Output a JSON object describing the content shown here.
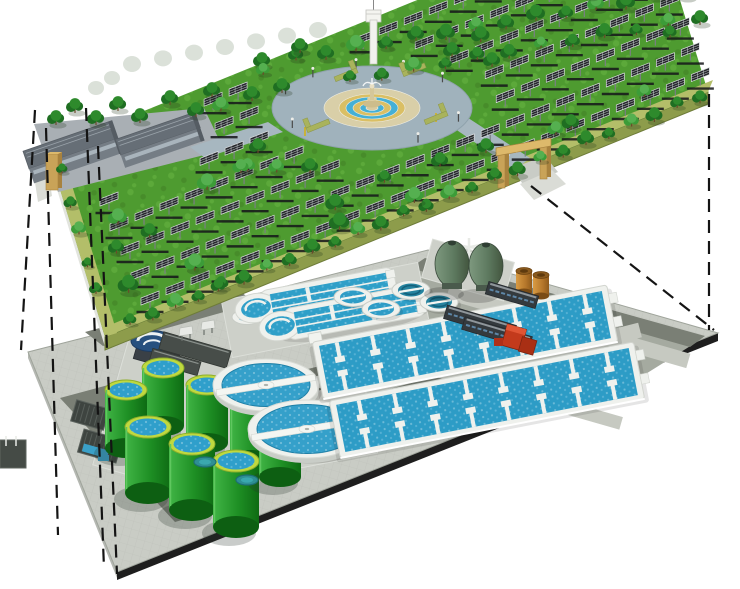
{
  "canvas": {
    "width": 740,
    "height": 589,
    "background": "#ffffff"
  },
  "palette": {
    "grass": "#4E9B30",
    "grass_light": "#5CA93A",
    "grass_dark": "#478C2A",
    "edge_walk": "#B3BE69",
    "front_face": "#8D9C4B",
    "left_face": "#E2E4DE",
    "road_upper": "#A7B7C0",
    "plaza_ring": "#A0B2BC",
    "plaza_beige": "#D9CFA8",
    "plaza_tan": "#DABF64",
    "plaza_blue": "#45B0D6",
    "fountain_stone": "#CDBD8C",
    "tan_gate": "#C9A358",
    "tan_gate_dark": "#A8823E",
    "tan_gate_light": "#DDB96B",
    "panel_cell": "#26282C",
    "panel_grid": "#C9CDD2",
    "panel_shadow": "#15161A",
    "tree_dark": "#1F6E22",
    "tree_mid": "#2E8A2C",
    "tree_light": "#3C9C38",
    "tree_faded": "#DBE1D9",
    "building_roof": "#666E76",
    "building_wall": "#757D85",
    "building_band": "#A9B4BC",
    "lower_base": "#C9CCC5",
    "lower_pad_med": "#A5AAA0",
    "road_dark": "#7A7F75",
    "road_light": "#C6C9C1",
    "edge_dark": "#1E1E1E",
    "side_light": "#B5B8B2",
    "tank_green": "#229426",
    "tank_green_dark": "#0F6B14",
    "tank_rim": "#BFD93F",
    "water_blue": "#2F9FC8",
    "water_deep": "#25839F",
    "white_struct": "#EFF1ED",
    "white_stroke": "#D2D5CF",
    "navy": "#27507F",
    "egg_green": "#5E7A60",
    "egg_dark": "#46604B",
    "barrel": "#C08030",
    "red_unit": "#C33A1C",
    "dash_line": "#141414"
  },
  "upper_level": {
    "polygon": [
      [
        48,
        150
      ],
      [
        651,
        -95
      ],
      [
        708,
        92
      ],
      [
        105,
        337
      ]
    ],
    "faces": {
      "front": [
        [
          105,
          337
        ],
        [
          708,
          92
        ],
        [
          708,
          104
        ],
        [
          105,
          350
        ]
      ],
      "left": [
        [
          48,
          150
        ],
        [
          105,
          337
        ],
        [
          105,
          347
        ],
        [
          48,
          160
        ]
      ]
    },
    "edge_walks": [
      [
        [
          105,
          337
        ],
        [
          708,
          92
        ],
        [
          713,
          80
        ],
        [
          110,
          325
        ]
      ],
      [
        [
          48,
          150
        ],
        [
          105,
          337
        ],
        [
          117,
          333
        ],
        [
          60,
          146
        ]
      ]
    ],
    "backdrop_slab": [
      [
        352,
        92
      ],
      [
        392,
        30
      ],
      [
        470,
        52
      ],
      [
        452,
        96
      ]
    ],
    "building_pad": [
      [
        34,
        124
      ],
      [
        204,
        108
      ],
      [
        224,
        150
      ],
      [
        58,
        192
      ]
    ],
    "roads": [
      [
        [
          268,
          122
        ],
        [
          283,
          132
        ],
        [
          205,
          158
        ],
        [
          190,
          147
        ]
      ],
      [
        [
          448,
          124
        ],
        [
          462,
          114
        ],
        [
          530,
          158
        ],
        [
          515,
          170
        ]
      ]
    ],
    "gate_aprons": [
      [
        [
          512,
          168
        ],
        [
          545,
          156
        ],
        [
          558,
          172
        ],
        [
          524,
          186
        ]
      ],
      [
        [
          520,
          184
        ],
        [
          552,
          170
        ],
        [
          566,
          184
        ],
        [
          534,
          200
        ]
      ],
      [
        [
          34,
          176
        ],
        [
          48,
          170
        ],
        [
          52,
          196
        ],
        [
          38,
          202
        ]
      ]
    ],
    "panel_field": {
      "row_starts": [
        [
          150,
          305
        ],
        [
          140,
          280
        ],
        [
          130,
          255
        ],
        [
          119,
          231
        ],
        [
          109,
          206
        ],
        [
          99,
          181
        ],
        [
          88,
          157
        ],
        [
          78,
          132
        ],
        [
          68,
          107
        ]
      ],
      "count": 24,
      "spacing": 27,
      "angle_deg": -22.1,
      "exclusions": {
        "plaza": {
          "cx": 372,
          "cy": 108,
          "rx": 118,
          "ry": 58
        },
        "buildings_rect": {
          "x1": 30,
          "y1": 105,
          "x2": 205,
          "y2": 198
        },
        "front_margin": 10,
        "left_margin": 14
      }
    },
    "plaza": {
      "cx": 372,
      "cy": 108,
      "rings": [
        {
          "rx": 100,
          "ry": 42,
          "fill": "ring_road"
        },
        {
          "rx": 48,
          "ry": 20,
          "fill": "beige"
        },
        {
          "rx": 33,
          "ry": 14,
          "fill": "tan"
        },
        {
          "rx": 26,
          "ry": 11,
          "fill": "blue"
        },
        {
          "rx": 19,
          "ry": 8,
          "fill": "tan"
        },
        {
          "rx": 12,
          "ry": 5,
          "fill": "blue"
        },
        {
          "rx": 6,
          "ry": 2.5,
          "fill": "island"
        }
      ],
      "pole_angles": [
        200,
        230,
        260,
        290,
        320,
        20,
        60,
        150
      ],
      "yellow_poles": [
        [
          436,
          122
        ],
        [
          305,
          136
        ]
      ],
      "planters": [
        {
          "x": 306,
          "y": 128,
          "flip": 0
        },
        {
          "x": 424,
          "y": 120,
          "flip": 1
        },
        {
          "x": 334,
          "y": 77,
          "flip": 1
        },
        {
          "x": 402,
          "y": 72,
          "flip": 0
        }
      ]
    },
    "buildings": [
      {
        "cx": 73,
        "cy": 152,
        "w": 94,
        "h": 34,
        "ang": -19
      },
      {
        "cx": 160,
        "cy": 140,
        "w": 84,
        "h": 30,
        "ang": -19
      }
    ],
    "gates": {
      "left_slab": {
        "x": 46,
        "y": 154
      },
      "right_posts": [
        [
          498,
          154
        ],
        [
          540,
          145
        ]
      ],
      "right_lintel": [
        [
          496,
          148
        ],
        [
          551,
          138
        ],
        [
          551,
          146
        ],
        [
          496,
          156
        ]
      ]
    },
    "tower": {
      "shaft": [
        370,
        20,
        7,
        44
      ],
      "cap": [
        366,
        10,
        15,
        12
      ],
      "antenna_x": 373.5
    },
    "tree_rows": [
      {
        "from": [
          130,
          323
        ],
        "to": [
          700,
          97
        ],
        "n": 26,
        "r": 8
      },
      {
        "from": [
          296,
          58
        ],
        "to": [
          686,
          -8
        ],
        "n": 14,
        "r": 9
      },
      {
        "from": [
          350,
          80
        ],
        "to": [
          700,
          18
        ],
        "n": 12,
        "r": 8
      },
      {
        "from": [
          62,
          172
        ],
        "to": [
          96,
          292
        ],
        "n": 5,
        "r": 7
      }
    ],
    "tree_singles": [
      [
        56,
        120
      ],
      [
        75,
        108
      ],
      [
        96,
        120
      ],
      [
        118,
        106
      ],
      [
        140,
        118
      ],
      [
        170,
        100
      ],
      [
        196,
        112
      ],
      [
        212,
        92
      ],
      [
        252,
        96
      ],
      [
        282,
        88
      ],
      [
        262,
        62
      ],
      [
        300,
        48
      ],
      [
        452,
        52
      ],
      [
        492,
        62
      ],
      [
        258,
        148
      ],
      [
        310,
        168
      ],
      [
        440,
        162
      ],
      [
        486,
        148
      ]
    ],
    "faded_trees": {
      "row_from": [
        132,
        64
      ],
      "row_to": [
        318,
        30
      ],
      "n": 7,
      "extra": [
        [
          96,
          88
        ],
        [
          112,
          78
        ]
      ]
    },
    "scatter": {
      "seed": 7,
      "count": 24
    }
  },
  "lower_level": {
    "polygon": [
      [
        428,
        250
      ],
      [
        718,
        333
      ],
      [
        117,
        572
      ],
      [
        28,
        352
      ]
    ],
    "faces": {
      "se": [
        [
          117,
          572
        ],
        [
          718,
          333
        ],
        [
          718,
          341
        ],
        [
          117,
          580
        ]
      ],
      "sw": [
        [
          28,
          352
        ],
        [
          117,
          572
        ],
        [
          117,
          578
        ],
        [
          28,
          358
        ]
      ]
    },
    "pad_right": [
      [
        420,
        265
      ],
      [
        700,
        340
      ],
      [
        580,
        415
      ],
      [
        330,
        348
      ]
    ],
    "roads_dark": [
      [
        [
          85,
          332
        ],
        [
          238,
          290
        ],
        [
          256,
          303
        ],
        [
          103,
          346
        ]
      ],
      [
        [
          128,
          462
        ],
        [
          465,
          368
        ],
        [
          530,
          402
        ],
        [
          192,
          500
        ]
      ],
      [
        [
          60,
          398
        ],
        [
          112,
          384
        ],
        [
          230,
          506
        ],
        [
          175,
          522
        ]
      ],
      [
        [
          425,
          258
        ],
        [
          705,
          336
        ],
        [
          690,
          347
        ],
        [
          410,
          268
        ]
      ]
    ],
    "roads_light": [
      {
        "from": [
          448,
          292
        ],
        "len": 250,
        "axis": "a",
        "w": 15
      },
      {
        "from": [
          640,
          330
        ],
        "len": 200,
        "axis": "b",
        "w": 15
      },
      {
        "from": [
          400,
          360
        ],
        "len": 230,
        "axis": "a",
        "w": 13
      }
    ],
    "stripes": [
      [
        196,
        402
      ],
      [
        196,
        424
      ],
      [
        196,
        446
      ]
    ],
    "pads_light": [
      {
        "cx": 325,
        "cy": 310,
        "w": 200,
        "h": 58,
        "ang": -11
      },
      {
        "cx": 307,
        "cy": 430,
        "w": 130,
        "h": 72,
        "ang": -11
      },
      {
        "cx": 190,
        "cy": 425,
        "w": 165,
        "h": 130,
        "ang": 16
      },
      {
        "cx": 468,
        "cy": 270,
        "w": 85,
        "h": 40,
        "ang": 16
      }
    ],
    "digesters": [
      [
        163,
        368
      ],
      [
        207,
        385
      ],
      [
        251,
        402
      ],
      [
        126,
        390
      ],
      [
        148,
        427
      ],
      [
        192,
        444
      ],
      [
        236,
        461
      ],
      [
        280,
        419
      ]
    ],
    "digester_size": {
      "rx": 21,
      "ry": 10,
      "h": 58
    },
    "teal_pads": [
      [
        205,
        462
      ],
      [
        247,
        480
      ]
    ],
    "navy_clarifier": {
      "cx": 152,
      "cy": 341,
      "rx": 21,
      "ry": 10.5,
      "base": {
        "cx": 158,
        "cy": 352,
        "w": 44,
        "h": 26,
        "ang": 16
      }
    },
    "white_tank": {
      "cx": 247,
      "cy": 317,
      "rx": 15,
      "ry": 7.5
    },
    "hoppers": [
      [
        186,
        328
      ],
      [
        208,
        322
      ]
    ],
    "base_buildings": [
      {
        "cx": 195,
        "cy": 350,
        "w": 70,
        "h": 18,
        "ang": 16
      },
      {
        "cx": 175,
        "cy": 362,
        "w": 50,
        "h": 14,
        "ang": 16
      }
    ],
    "intakes": [
      {
        "cx": 90,
        "cy": 415,
        "w": 34,
        "h": 22,
        "ang": 16,
        "blue": false
      },
      {
        "cx": 100,
        "cy": 446,
        "w": 40,
        "h": 24,
        "ang": 16,
        "blue": true
      }
    ],
    "edge_box": [
      0,
      440,
      26,
      28
    ],
    "tiny_pool": [
      98,
      455,
      11,
      6
    ],
    "ditches": [
      {
        "bx": 256,
        "by": 308,
        "ang": -10.5,
        "len": 142
      },
      {
        "bx": 280,
        "by": 326,
        "ang": -10.5,
        "len": 146
      }
    ],
    "small_tanks": [
      {
        "cx": 353,
        "cy": 297,
        "deep": false
      },
      {
        "cx": 381,
        "cy": 309,
        "deep": false
      },
      {
        "cx": 411,
        "cy": 290,
        "deep": true
      },
      {
        "cx": 439,
        "cy": 302,
        "deep": true
      }
    ],
    "clarifiers": [
      {
        "cx": 266,
        "cy": 385,
        "rx": 46,
        "ry": 22.5
      },
      {
        "cx": 307,
        "cy": 429,
        "rx": 52,
        "ry": 25.5
      }
    ],
    "basins": [
      {
        "cx": 465,
        "cy": 342,
        "len": 300,
        "h": 58,
        "ang": -11
      },
      {
        "cx": 487,
        "cy": 400,
        "len": 310,
        "h": 58,
        "ang": -11
      }
    ],
    "eggs": {
      "centers": [
        [
          452,
          264
        ],
        [
          486,
          266
        ]
      ],
      "rx": 17,
      "ry": 23
    },
    "barrels": [
      [
        524,
        281
      ],
      [
        541,
        285
      ]
    ],
    "buildings": [
      {
        "cx": 512,
        "cy": 295,
        "w": 52,
        "h": 13,
        "ang": 16.5
      },
      {
        "cx": 480,
        "cy": 322,
        "w": 72,
        "h": 14,
        "ang": 16.5
      },
      {
        "cx": 497,
        "cy": 333,
        "w": 70,
        "h": 13,
        "ang": 16.5
      }
    ],
    "red_unit": {
      "cx": 520,
      "cy": 338,
      "ang": 16
    },
    "red_box": [
      494,
      338,
      9,
      8
    ]
  },
  "projection_lines": [
    {
      "x1": 35,
      "y1": 110,
      "x2": 21,
      "y2": 350
    },
    {
      "x1": 46,
      "y1": 128,
      "x2": 58,
      "y2": 535
    },
    {
      "x1": 86,
      "y1": 108,
      "x2": 104,
      "y2": 568
    },
    {
      "x1": 98,
      "y1": 146,
      "x2": 117,
      "y2": 574
    },
    {
      "x1": 709,
      "y1": 94,
      "x2": 709,
      "y2": 330
    },
    {
      "x1": 531,
      "y1": 186,
      "x2": 714,
      "y2": 330
    }
  ]
}
